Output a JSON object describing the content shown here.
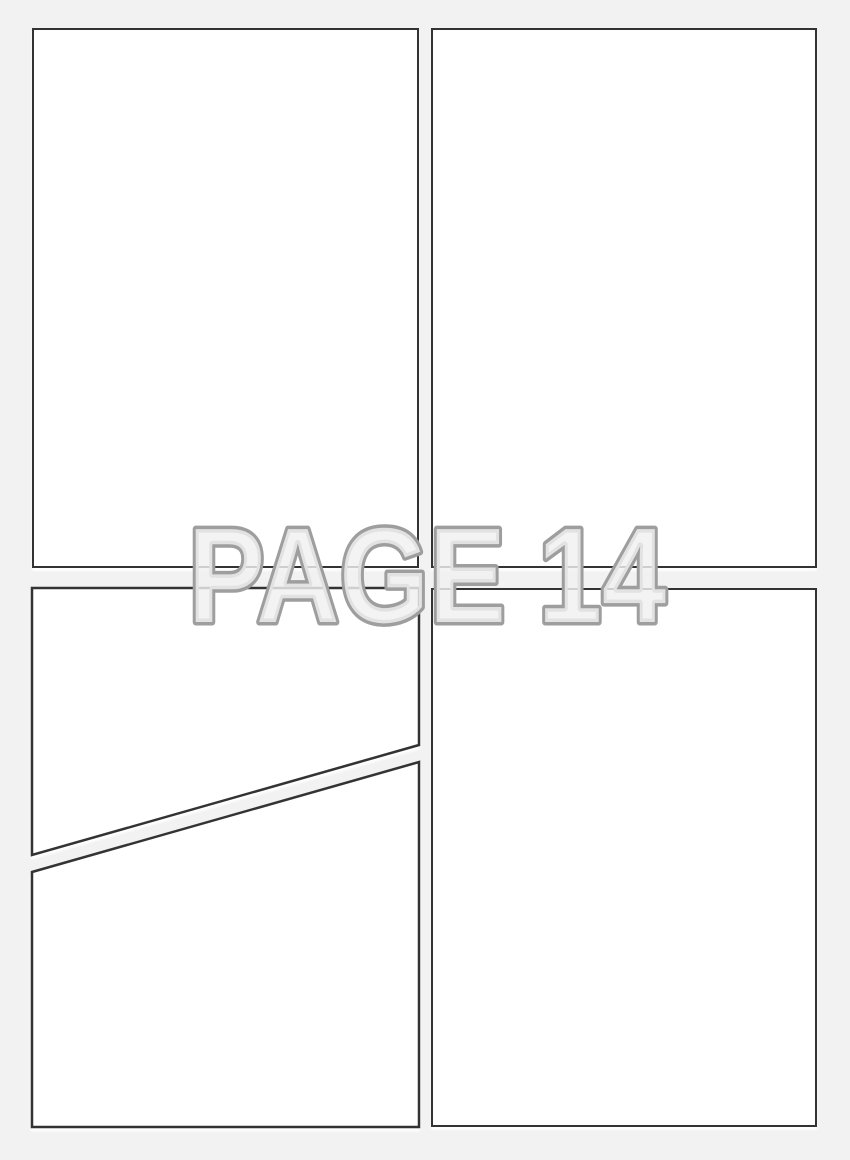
{
  "page": {
    "title": "PAGE 14",
    "number": "14"
  },
  "colors": {
    "page_bg": "#f2f2f2",
    "panel_fill": "#ffffff",
    "panel_border": "#333333",
    "title_fill": "#f0f0f0",
    "title_stroke": "#9e9e9e"
  },
  "panels": [
    {
      "name": "panel-top-left",
      "shape": "rectangle"
    },
    {
      "name": "panel-top-right",
      "shape": "rectangle"
    },
    {
      "name": "panel-bottom-left-upper",
      "shape": "diagonal-trapezoid"
    },
    {
      "name": "panel-bottom-left-lower",
      "shape": "diagonal-trapezoid"
    },
    {
      "name": "panel-bottom-right",
      "shape": "rectangle"
    }
  ]
}
